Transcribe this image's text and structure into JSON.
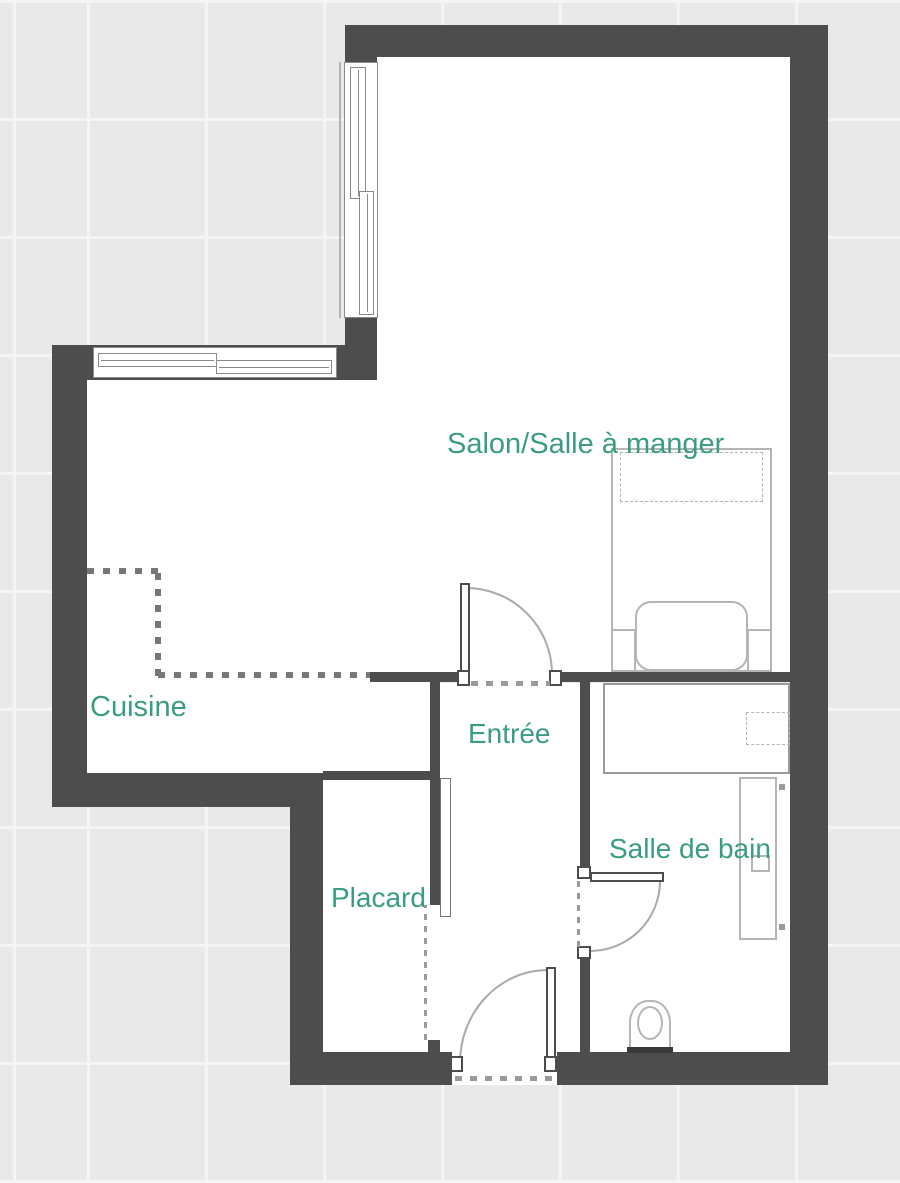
{
  "plan": {
    "title": "Plan d'appartement studio",
    "rooms": {
      "salon": {
        "label": "Salon/Salle à manger"
      },
      "cuisine": {
        "label": "Cuisine"
      },
      "entree": {
        "label": "Entrée"
      },
      "placard": {
        "label": "Placard"
      },
      "salle_de_bain": {
        "label": "Salle de bain"
      }
    },
    "colors": {
      "wall": "#4d4d4d",
      "floor": "#ffffff",
      "background": "#e9e9e9",
      "grout": "#f5f5f5",
      "label": "#3a9c82",
      "furniture_line": "#b5b5b5"
    }
  }
}
